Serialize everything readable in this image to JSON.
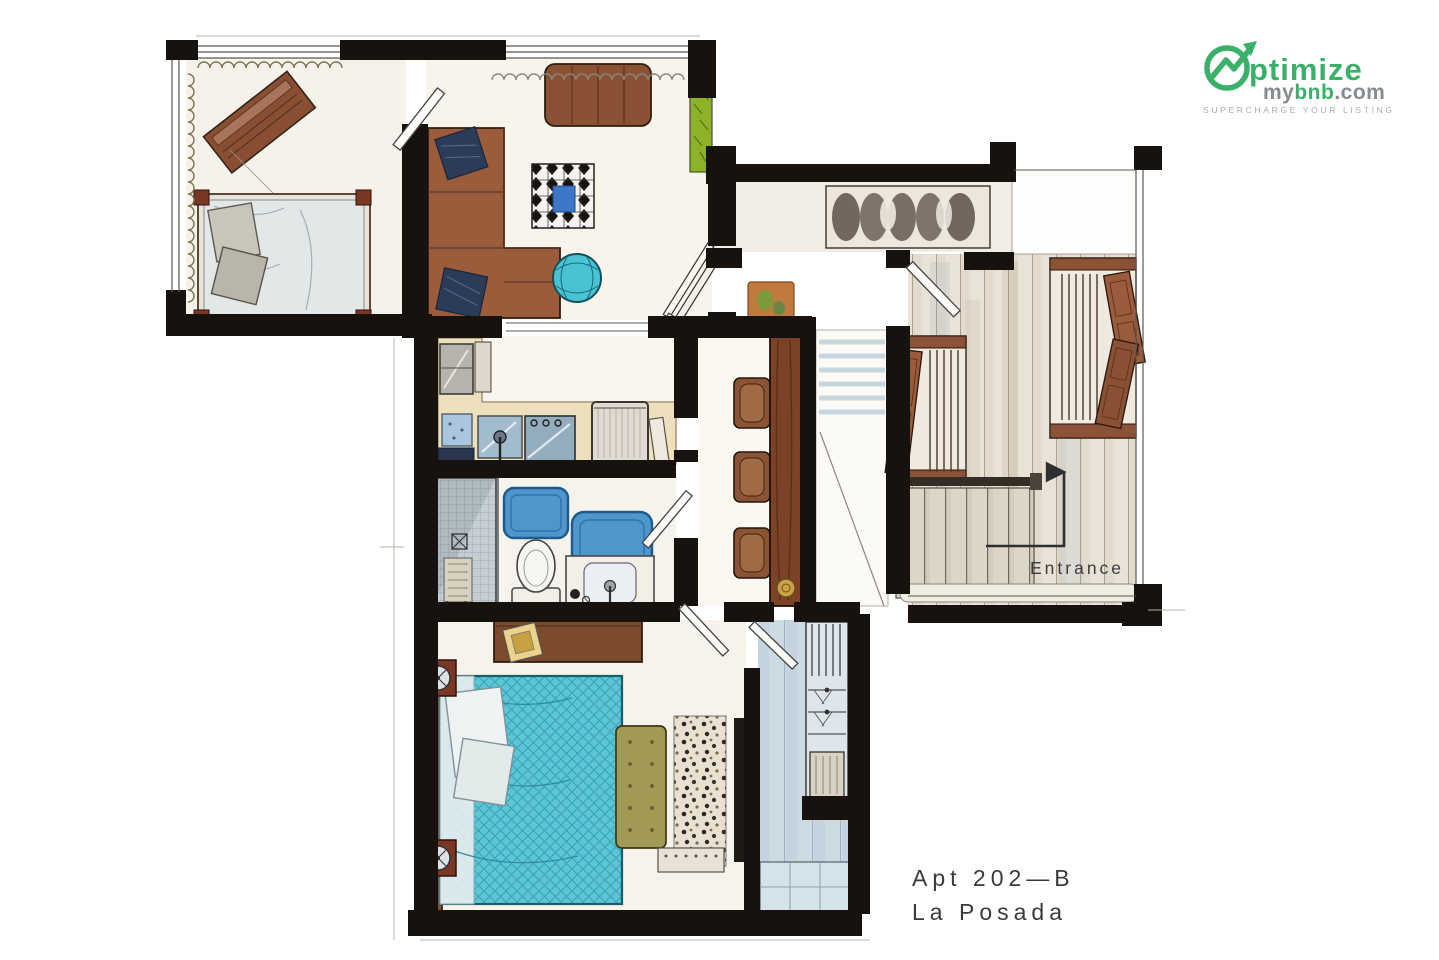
{
  "header": {
    "logo": {
      "word_main": "ptimize",
      "sub_my": "my",
      "sub_bnb": "bnb",
      "sub_dot_com": ".com",
      "tagline": "SUPERCHARGE YOUR LISTING"
    }
  },
  "plan": {
    "entrance_label": "Entrance"
  },
  "caption": {
    "line1": "Apt 202—B",
    "line2": "La Posada"
  },
  "colors": {
    "logo_green": "#3bb069",
    "logo_gray": "#858b91",
    "tagline_gray": "#a7adb3",
    "label_ink": "#3d3d3d",
    "wall_ink": "#17120d",
    "sofa_brown": "#9a5c3a",
    "bed_teal": "#57c4d4",
    "bath_mat_blue": "#4e96cc",
    "bar_counter_brown": "#7a4226",
    "planter_green": "#8cb229",
    "bench_olive": "#a29a52",
    "hall_wood": "#e9e2d6"
  }
}
